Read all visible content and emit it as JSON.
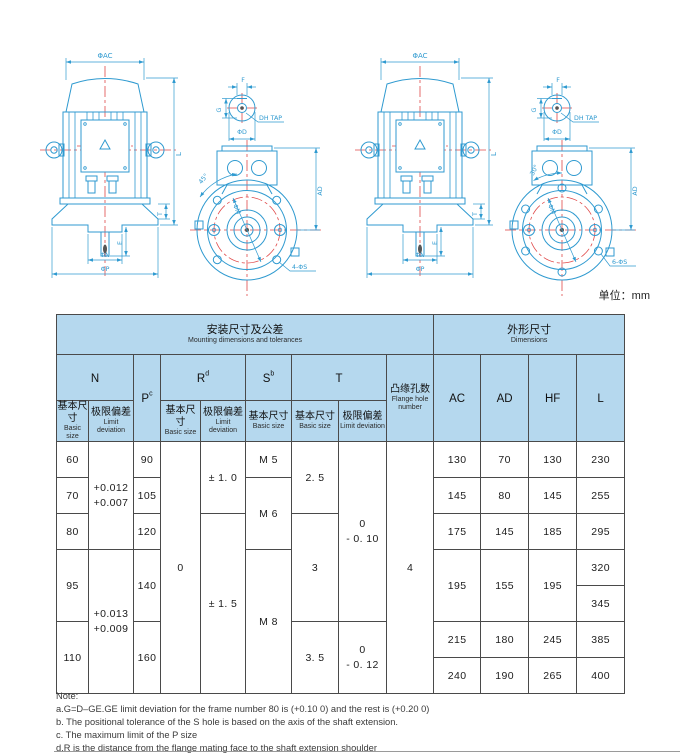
{
  "page": {
    "unit_label": "单位：mm"
  },
  "colors": {
    "drawing_line": "#2f9ad0",
    "centerline_red": "#e04848",
    "table_header_bg": "#b5d8ee",
    "grid_line": "#4a4a4a"
  },
  "drawings": {
    "left": {
      "side": {
        "ac": "ΦAC",
        "l": "L",
        "t": "T",
        "e": "E",
        "n": "ΦN",
        "p": "ΦP"
      },
      "shaft": {
        "f": "F",
        "g": "G",
        "tap": "DH TAP",
        "d": "ΦD"
      },
      "flange": {
        "angle": "45°",
        "m": "ΦM",
        "ad": "AD",
        "holes": "4-ΦS"
      }
    },
    "right": {
      "side": {
        "ac": "ΦAC",
        "l": "L",
        "t": "T",
        "e": "E",
        "n": "ΦN",
        "p": "ΦP"
      },
      "shaft": {
        "f": "F",
        "g": "G",
        "tap": "DH TAP",
        "d": "ΦD"
      },
      "flange": {
        "angle": "30°",
        "m": "ΦM",
        "ad": "AD",
        "holes": "6-ΦS"
      }
    }
  },
  "table": {
    "group_headers": {
      "mounting_zh": "安装尺寸及公差",
      "mounting_en": "Mounting dimensions and tolerances",
      "overall_zh": "外形尺寸",
      "overall_en": "Dimensions"
    },
    "columns": {
      "n": "N",
      "p": "P",
      "p_sup": "c",
      "r": "R",
      "r_sup": "d",
      "s": "S",
      "s_sup": "b",
      "t": "T",
      "flange_zh": "凸缘孔数",
      "flange_en": "Flange hole number",
      "ac": "AC",
      "ad": "AD",
      "hf": "HF",
      "l": "L",
      "basic_zh": "基本尺寸",
      "basic_en": "Basic size",
      "dev_zh": "极限偏差",
      "dev_en": "Limit deviation"
    },
    "body": {
      "n_basic": [
        "60",
        "70",
        "80",
        "95",
        "110"
      ],
      "n_dev": [
        "+0.012\n+0.007",
        "+0.013\n+0.009"
      ],
      "p": [
        "90",
        "105",
        "120",
        "140",
        "160"
      ],
      "r_basic": "0",
      "r_dev": [
        "± 1. 0",
        "± 1. 5"
      ],
      "s": [
        "M 5",
        "M 6",
        "M 8"
      ],
      "t_basic": [
        "2. 5",
        "3",
        "3. 5"
      ],
      "t_dev": [
        "0\n- 0. 10",
        "0\n- 0. 12"
      ],
      "flange_holes": "4",
      "ac": [
        "130",
        "145",
        "175",
        "195",
        "215",
        "240"
      ],
      "ad": [
        "70",
        "80",
        "145",
        "155",
        "180",
        "190"
      ],
      "hf": [
        "130",
        "145",
        "185",
        "195",
        "245",
        "265"
      ],
      "l": [
        "230",
        "255",
        "295",
        "320",
        "345",
        "385",
        "400"
      ]
    }
  },
  "note": {
    "lines": [
      "Note:",
      "a.G=D–GE.GE limit deviation for the frame number 80 is (+0.10  0) and  the rest is (+0.20  0)",
      "b. The positional tolerance of the S hole is based on the  axis of the shaft extension.",
      "c. The maximum limit of the P size",
      "d.R is the distance from the flange mating face to the shaft extension shoulder"
    ]
  }
}
